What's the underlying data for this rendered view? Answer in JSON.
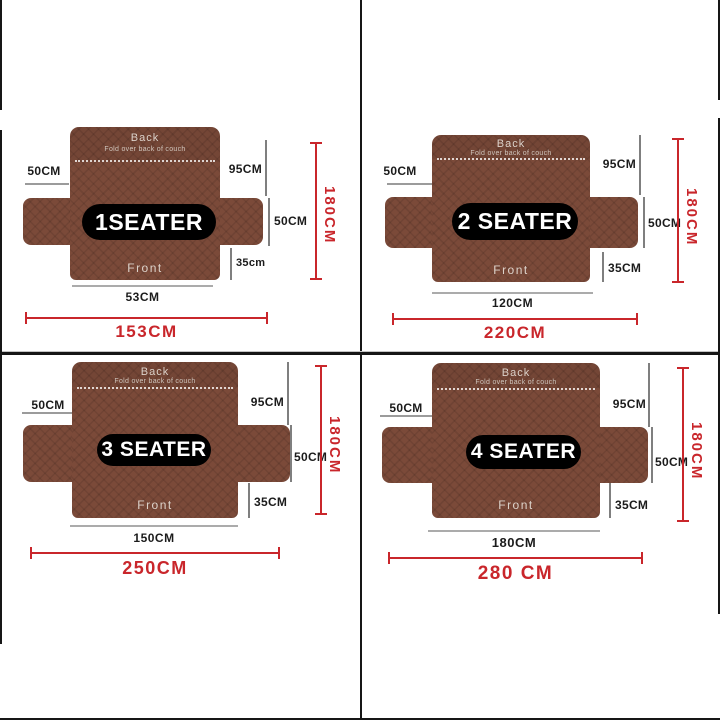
{
  "colors": {
    "background": "#ffffff",
    "couch_brown": "#7b4a39",
    "badge_black": "#000000",
    "badge_text": "#ffffff",
    "dimension_text": "#1b1b1b",
    "gray_line": "#9b9b9b",
    "accent_red": "#c9262b",
    "divider_black": "#161616"
  },
  "quadrants": [
    {
      "badge": "1SEATER",
      "back_title": "Back",
      "back_subtitle": "Fold over back of couch",
      "front_title": "Front",
      "arm_width": "50CM",
      "back_height": "95CM",
      "side_height": "50CM",
      "front_drop": "35cm",
      "seat_width": "53CM",
      "total_width": "153CM",
      "total_height": "180CM"
    },
    {
      "badge": "2 SEATER",
      "back_title": "Back",
      "back_subtitle": "Fold over back of couch",
      "front_title": "Front",
      "arm_width": "50CM",
      "back_height": "95CM",
      "side_height": "50CM",
      "front_drop": "35CM",
      "seat_width": "120CM",
      "total_width": "220CM",
      "total_height": "180CM"
    },
    {
      "badge": "3 SEATER",
      "back_title": "Back",
      "back_subtitle": "Fold over back of couch",
      "front_title": "Front",
      "arm_width": "50CM",
      "back_height": "95CM",
      "side_height": "50CM",
      "front_drop": "35CM",
      "seat_width": "150CM",
      "total_width": "250CM",
      "total_height": "180CM"
    },
    {
      "badge": "4 SEATER",
      "back_title": "Back",
      "back_subtitle": "Fold over back of couch",
      "front_title": "Front",
      "arm_width": "50CM",
      "back_height": "95CM",
      "side_height": "50CM",
      "front_drop": "35CM",
      "seat_width": "180CM",
      "total_width": "280 CM",
      "total_height": "180CM"
    }
  ]
}
